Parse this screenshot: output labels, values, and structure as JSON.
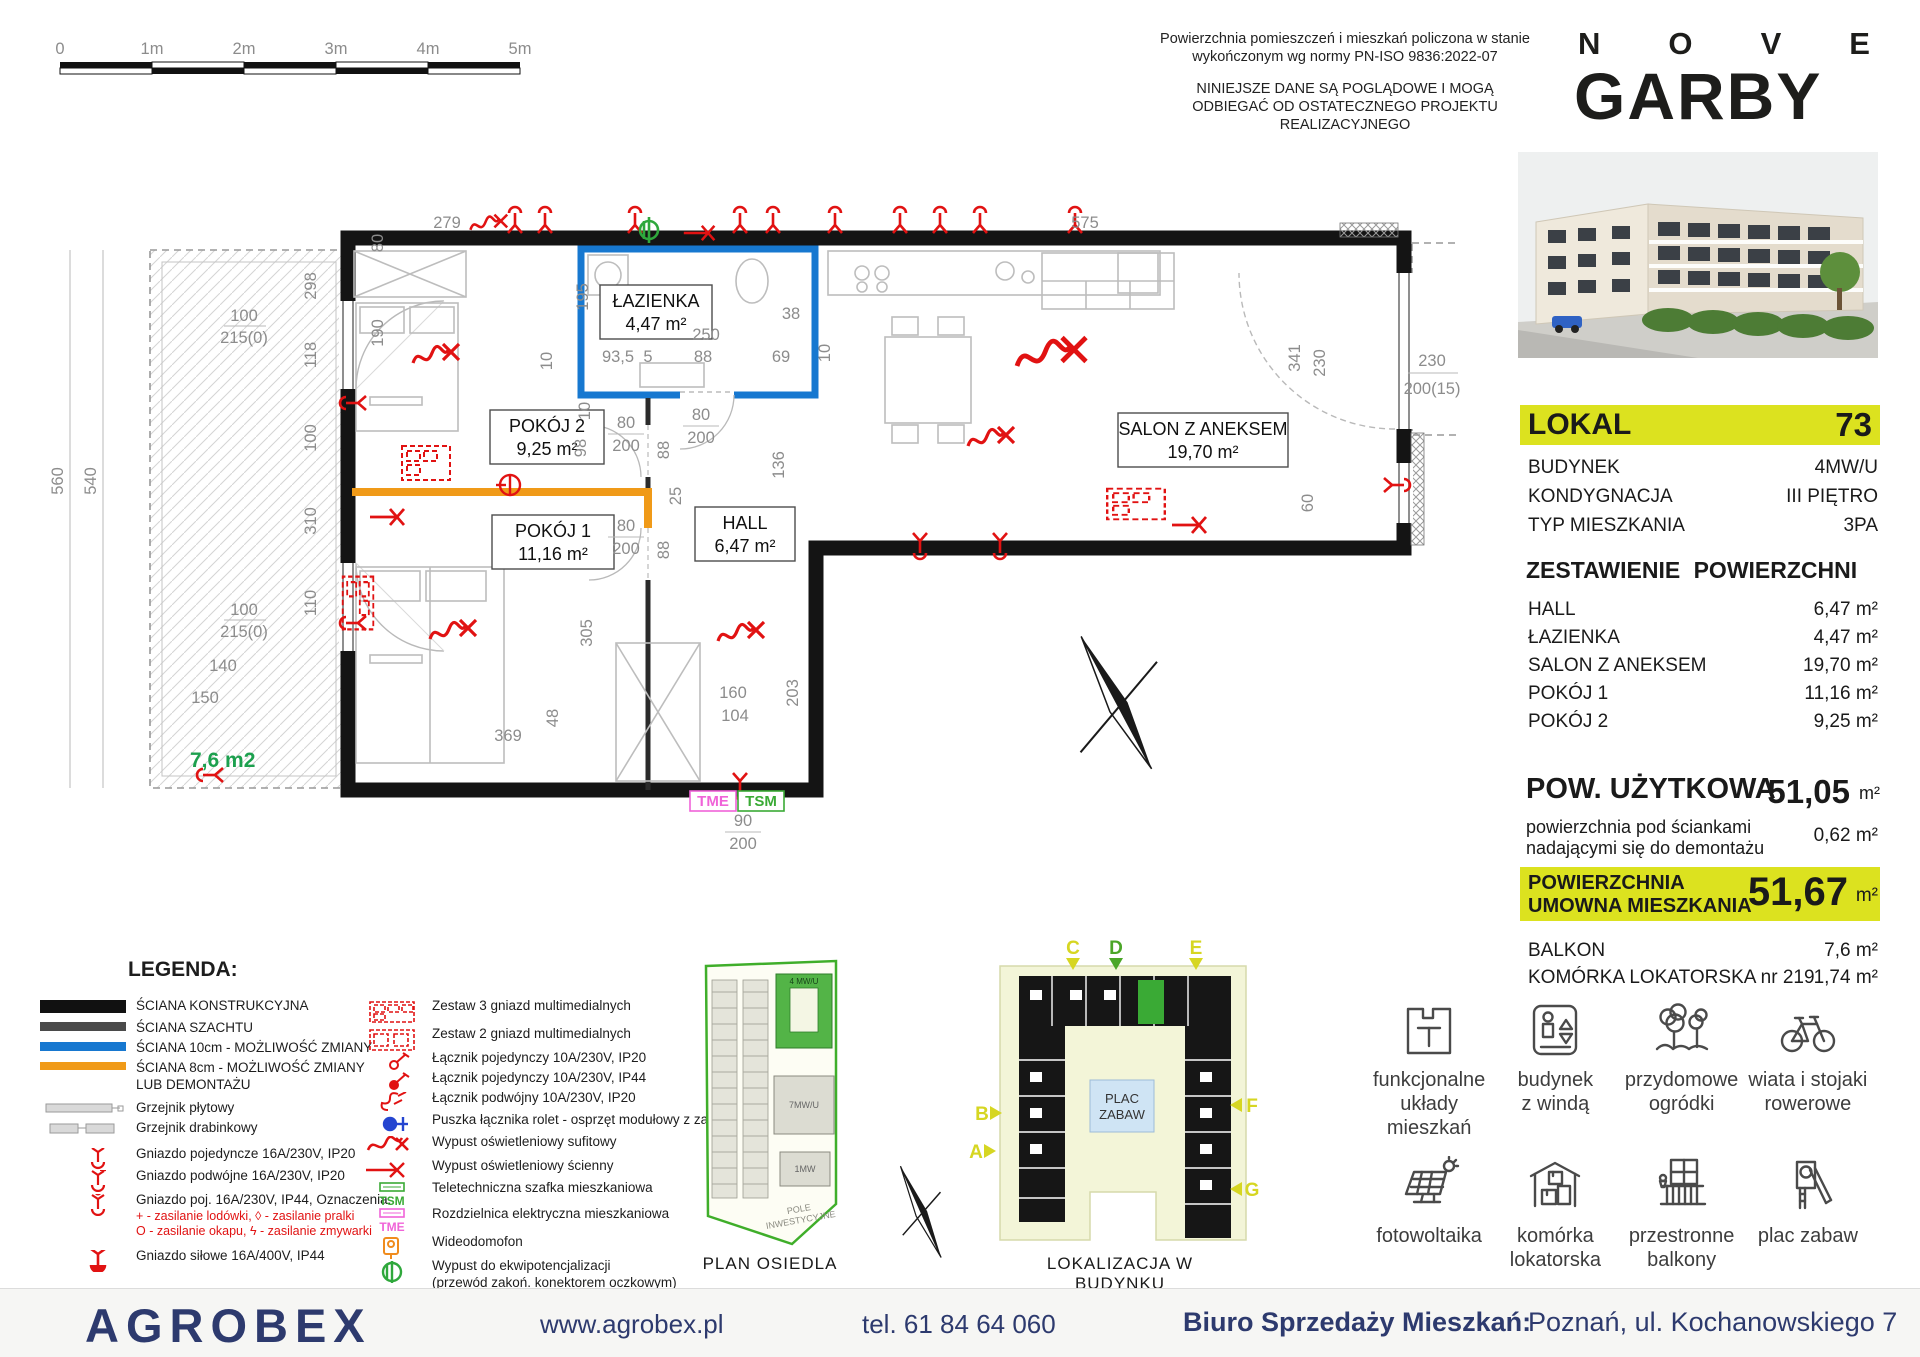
{
  "scale_bar": {
    "ticks": [
      "0",
      "1m",
      "2m",
      "3m",
      "4m",
      "5m"
    ]
  },
  "disclaimer": {
    "p1": "Powierzchnia pomieszczeń i mieszkań policzona w stanie wykończonym wg normy PN-ISO 9836:2022-07",
    "p2": "NINIEJSZE DANE SĄ POGLĄDOWE I MOGĄ ODBIEGAĆ OD OSTATECZNEGO PROJEKTU REALIZACYJNEGO"
  },
  "brand": {
    "n1": "N",
    "n2": "O",
    "n3": "V",
    "n4": "E",
    "bottom": "GARBY"
  },
  "unit": {
    "lokal_label": "LOKAL",
    "lokal_number": "73",
    "info": [
      {
        "label": "BUDYNEK",
        "value": "4MW/U"
      },
      {
        "label": "KONDYGNACJA",
        "value": "III PIĘTRO"
      },
      {
        "label": "TYP MIESZKANIA",
        "value": "3PA"
      }
    ],
    "areas_title": "ZESTAWIENIE POWIERZCHNI",
    "areas": [
      {
        "label": "HALL",
        "value": "6,47 m²"
      },
      {
        "label": "ŁAZIENKA",
        "value": "4,47 m²"
      },
      {
        "label": "SALON Z ANEKSEM",
        "value": "19,70 m²"
      },
      {
        "label": "POKÓJ 1",
        "value": "11,16 m²"
      },
      {
        "label": "POKÓJ 2",
        "value": "9,25 m²"
      }
    ],
    "usable_label": "POW. UŻYTKOWA",
    "usable_value": "51,05",
    "usable_unit": "m²",
    "walls_note_line1": "powierzchnia pod ściankami",
    "walls_note_line2": "nadającymi się do demontażu",
    "walls_note_value": "0,62 m²",
    "contract_line1": "POWIERZCHNIA",
    "contract_line2": "UMOWNA MIESZKANIA",
    "contract_value": "51,67",
    "contract_unit": "m²",
    "extras": [
      {
        "label": "BALKON",
        "value": "7,6 m²"
      },
      {
        "label": "KOMÓRKA LOKATORSKA nr 219",
        "value": "1,74 m²"
      }
    ]
  },
  "plan": {
    "rooms": [
      {
        "name": "ŁAZIENKA",
        "area": "4,47 m²"
      },
      {
        "name": "POKÓJ 2",
        "area": "9,25 m²"
      },
      {
        "name": "POKÓJ 1",
        "area": "11,16 m²"
      },
      {
        "name": "HALL",
        "area": "6,47 m²"
      },
      {
        "name": "SALON Z ANEKSEM",
        "area": "19,70 m²"
      }
    ],
    "balcony_area": "7,6 m2",
    "tme": "TME",
    "tsm": "TSM",
    "dims": [
      {
        "t": "279",
        "x": 407,
        "y": 43
      },
      {
        "t": "575",
        "x": 1045,
        "y": 43
      },
      {
        "t": "195",
        "x": 548,
        "y": 112,
        "r": 1
      },
      {
        "t": "10",
        "x": 512,
        "y": 176,
        "r": 1
      },
      {
        "t": "93,5",
        "x": 578,
        "y": 177
      },
      {
        "t": "5",
        "x": 608,
        "y": 177
      },
      {
        "t": "88",
        "x": 663,
        "y": 177
      },
      {
        "t": "69",
        "x": 741,
        "y": 177
      },
      {
        "t": "250",
        "x": 666,
        "y": 155
      },
      {
        "t": "38",
        "x": 751,
        "y": 134
      },
      {
        "t": "10",
        "x": 790,
        "y": 168,
        "r": 1
      },
      {
        "t": "80",
        "x": 586,
        "y": 243
      },
      {
        "t": "200",
        "x": 586,
        "y": 266
      },
      {
        "t": "80",
        "x": 661,
        "y": 235
      },
      {
        "t": "200",
        "x": 661,
        "y": 258
      },
      {
        "t": "80",
        "x": 586,
        "y": 346
      },
      {
        "t": "200",
        "x": 586,
        "y": 369
      },
      {
        "t": "88",
        "x": 629,
        "y": 265,
        "r": 1
      },
      {
        "t": "88",
        "x": 629,
        "y": 365,
        "r": 1
      },
      {
        "t": "98",
        "x": 546,
        "y": 263,
        "r": 1
      },
      {
        "t": "10",
        "x": 550,
        "y": 226,
        "r": 1
      },
      {
        "t": "25",
        "x": 641,
        "y": 311,
        "r": 1
      },
      {
        "t": "136",
        "x": 744,
        "y": 280,
        "r": 1
      },
      {
        "t": "298",
        "x": 276,
        "y": 101,
        "r": 1
      },
      {
        "t": "118",
        "x": 276,
        "y": 170,
        "r": 1
      },
      {
        "t": "100",
        "x": 276,
        "y": 253,
        "r": 1
      },
      {
        "t": "310",
        "x": 276,
        "y": 336,
        "r": 1
      },
      {
        "t": "110",
        "x": 276,
        "y": 418,
        "r": 1
      },
      {
        "t": "80",
        "x": 343,
        "y": 58,
        "r": 1
      },
      {
        "t": "190",
        "x": 343,
        "y": 148,
        "r": 1
      },
      {
        "t": "305",
        "x": 552,
        "y": 448,
        "r": 1
      },
      {
        "t": "369",
        "x": 468,
        "y": 556
      },
      {
        "t": "48",
        "x": 518,
        "y": 533,
        "r": 1
      },
      {
        "t": "160",
        "x": 693,
        "y": 513
      },
      {
        "t": "104",
        "x": 695,
        "y": 536
      },
      {
        "t": "203",
        "x": 758,
        "y": 508,
        "r": 1
      },
      {
        "t": "90",
        "x": 703,
        "y": 641
      },
      {
        "t": "200",
        "x": 703,
        "y": 664
      },
      {
        "t": "341",
        "x": 1260,
        "y": 173,
        "r": 1
      },
      {
        "t": "230",
        "x": 1285,
        "y": 178,
        "r": 1
      },
      {
        "t": "60",
        "x": 1273,
        "y": 318,
        "r": 1
      },
      {
        "t": "230",
        "x": 1392,
        "y": 181
      },
      {
        "t": "200(15)",
        "x": 1392,
        "y": 209
      },
      {
        "t": "100",
        "x": 204,
        "y": 136
      },
      {
        "t": "215(0)",
        "x": 204,
        "y": 158
      },
      {
        "t": "100",
        "x": 204,
        "y": 430
      },
      {
        "t": "215(0)",
        "x": 204,
        "y": 452
      },
      {
        "t": "140",
        "x": 183,
        "y": 486
      },
      {
        "t": "150",
        "x": 165,
        "y": 518
      },
      {
        "t": "560",
        "x": 23,
        "y": 296,
        "r": 1
      },
      {
        "t": "540",
        "x": 56,
        "y": 296,
        "r": 1
      }
    ]
  },
  "minimaps": {
    "estate_caption": "PLAN OSIEDLA",
    "building_caption": "LOKALIZACJA  W BUDYNKU",
    "estate_labels": {
      "b1": "4 MW/U",
      "b2": "7MW/U",
      "b3": "1MW",
      "field1": "POLE",
      "field2": "INWESTYCYJNE"
    },
    "plac1": "PLAC",
    "plac2": "ZABAW",
    "markers": [
      "C",
      "D",
      "E",
      "B",
      "A",
      "F",
      "G"
    ]
  },
  "legend": {
    "title": "LEGENDA:",
    "col1": [
      {
        "label": "ŚCIANA KONSTRUKCYJNA"
      },
      {
        "label": "ŚCIANA SZACHTU"
      },
      {
        "label": "ŚCIANA 10cm - MOŻLIWOŚĆ ZMIANY"
      },
      {
        "label": "ŚCIANA 8cm - MOŻLIWOŚĆ ZMIANY",
        "label2": "LUB DEMONTAŻU"
      },
      {
        "label": "Grzejnik płytowy"
      },
      {
        "label": "Grzejnik drabinkowy"
      },
      {
        "label": "Gniazdo pojedyncze 16A/230V, IP20"
      },
      {
        "label": "Gniazdo podwójne 16A/230V, IP20"
      },
      {
        "label": "Gniazdo poj. 16A/230V, IP44, Oznaczenia:"
      },
      {
        "label": "Gniazdo siłowe 16A/400V, IP44"
      }
    ],
    "ip44_note1": "+  - zasilanie lodówki,   ◊  - zasilanie pralki",
    "ip44_note2": "O  - zasilanie okapu,   ϟ  - zasilanie zmywarki",
    "col2": [
      {
        "label": "Zestaw 3 gniazd multimedialnych"
      },
      {
        "label": "Zestaw 2 gniazd multimedialnych"
      },
      {
        "label": "Łącznik pojedynczy 10A/230V, IP20"
      },
      {
        "label": "Łącznik pojedynczy 10A/230V, IP44"
      },
      {
        "label": "Łącznik podwójny 10A/230V, IP20"
      },
      {
        "label": "Puszka łącznika rolet - osprzęt modułowy z zaślepką"
      },
      {
        "label": "Wypust oświetleniowy sufitowy"
      },
      {
        "label": "Wypust oświetleniowy ścienny"
      },
      {
        "label": "Teletechniczna szafka mieszkaniowa",
        "tag": "TSM"
      },
      {
        "label": "Rozdzielnica elektryczna mieszkaniowa",
        "tag": "TME"
      },
      {
        "label": "Wideodomofon"
      },
      {
        "label": "Wypust do ekwipotencjalizacji",
        "label2": "(przewód zakoń. konektorem oczkowym)"
      }
    ]
  },
  "features": [
    {
      "label1": "funkcjonalne",
      "label2": "układy mieszkań"
    },
    {
      "label1": "budynek",
      "label2": "z windą"
    },
    {
      "label1": "przydomowe",
      "label2": "ogródki"
    },
    {
      "label1": "wiata i stojaki",
      "label2": "rowerowe"
    },
    {
      "label1": "fotowoltaika",
      "label2": ""
    },
    {
      "label1": "komórka",
      "label2": "lokatorska"
    },
    {
      "label1": "przestronne",
      "label2": "balkony"
    },
    {
      "label1": "plac zabaw",
      "label2": ""
    }
  ],
  "footer": {
    "logo": "AGROBEX",
    "website": "www.agrobex.pl",
    "phone": "tel. 61 84 64 060",
    "office_label": "Biuro Sprzedaży Mieszkań:",
    "office_address": "Poznań, ul. Kochanowskiego 7"
  },
  "colors": {
    "accent_yellow": "#dce21f",
    "navy": "#2d3a6e",
    "wall_blue": "#1778d0",
    "wall_orange": "#f09a18",
    "symbol_red": "#e11212",
    "green": "#3aaa35",
    "magenta": "#f063d8"
  }
}
